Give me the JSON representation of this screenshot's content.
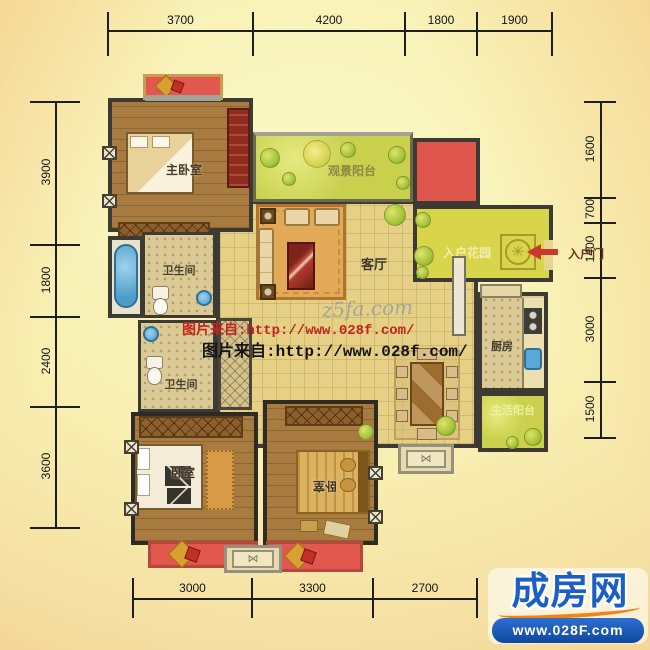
{
  "dimensions": {
    "top": [
      "3700",
      "4200",
      "1800",
      "1900"
    ],
    "left": [
      "3900",
      "1800",
      "2400",
      "3600"
    ],
    "right": [
      "1600",
      "700",
      "1400",
      "3000",
      "1500"
    ],
    "bottom": [
      "3000",
      "3300",
      "2700"
    ]
  },
  "rooms": {
    "master_bedroom": "主卧室",
    "bathroom_upper": "卫生间",
    "bathroom_lower": "卫生间",
    "viewing_balcony": "观景阳台",
    "living_room": "客厅",
    "entrance_garden": "入户花园",
    "entrance_door": "入户门",
    "kitchen": "厨房",
    "life_balcony": "生活阳台",
    "bedroom_left": "卧室",
    "bedroom_right": "卧室"
  },
  "watermarks": {
    "script": "z5fa.com",
    "line1": "图片来自:http://www.028f.com/",
    "line2": "图片来自:http://www.028f.com/"
  },
  "logo": {
    "name": "成房网",
    "url": "www.028F.com"
  },
  "icons": {
    "ac_unit": "⋈",
    "garden_medallion": "✳"
  },
  "colors": {
    "wall": "#3c3a32",
    "wood_floor": "#a87c40",
    "tile_floor": "#e5d085",
    "bath_tile": "#dcca96",
    "balcony_green": "#c9d04e",
    "garden_yellow": "#d9d54b",
    "red_block": "#df564c",
    "watermark_red": "#c32420",
    "logo_blue": "#1b5fc6",
    "logo_bar_blue": "#0e47a0",
    "logo_orange": "#ef8418"
  }
}
